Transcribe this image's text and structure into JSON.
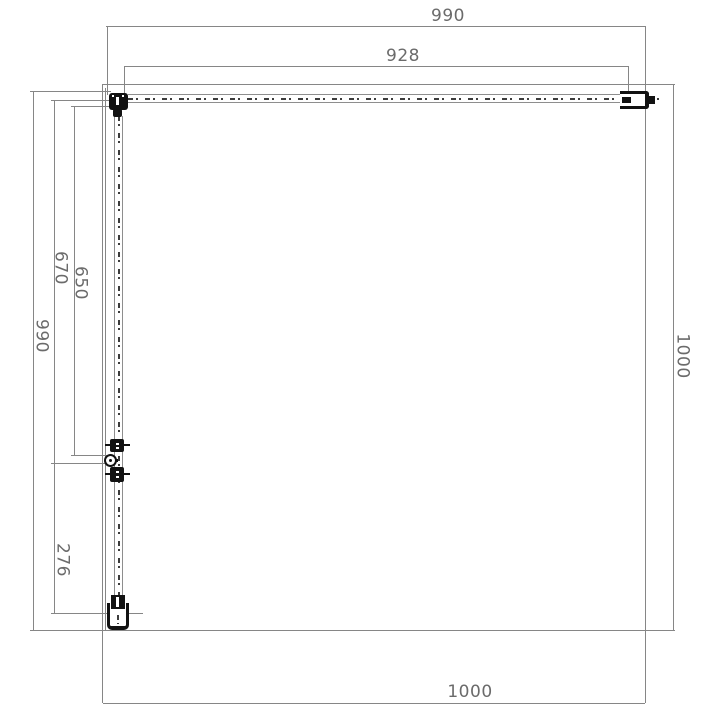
{
  "drawing": {
    "title": "shower-enclosure-top-view-technical-drawing",
    "units": "mm",
    "dims": {
      "top_overall": "990",
      "top_panel": "928",
      "left_overall": "990",
      "left_door_with_hinge": "670",
      "left_door_glass": "650",
      "left_fixed_panel": "276",
      "side_overall": "1000",
      "bottom_overall": "1000"
    },
    "colors": {
      "background": "#ffffff",
      "line": "#868686",
      "glass_edge": "#8e8e8e",
      "centerline": "#3c3c3c",
      "hardware": "#121212",
      "text": "#6b6b6b"
    }
  }
}
